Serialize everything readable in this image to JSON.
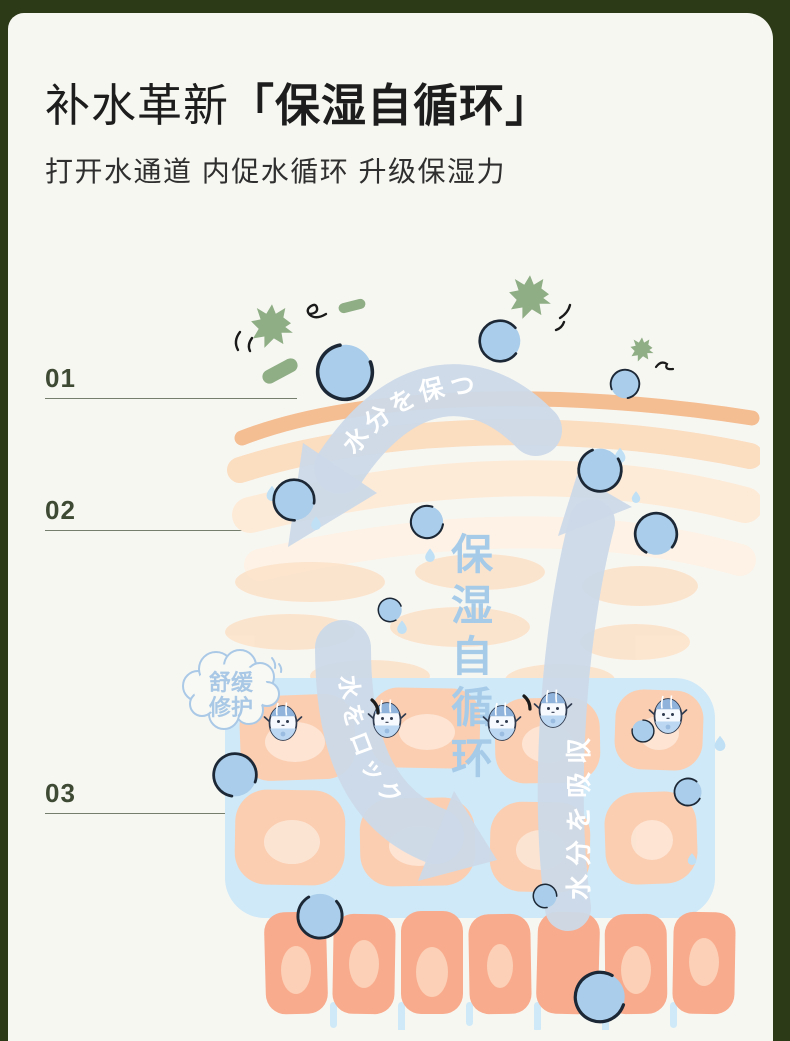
{
  "header": {
    "title_prefix": "补水革新",
    "title_quoted": "「保湿自循环」",
    "subtitle": "打开水通道 内促水循环 升级保湿力"
  },
  "steps": [
    {
      "label": "01"
    },
    {
      "label": "02"
    },
    {
      "label": "03"
    }
  ],
  "diagram": {
    "arrow_keep_moisture": "水分を保つ",
    "arrow_absorb_moisture": "水分を吸収",
    "arrow_lock_water": "水をロック",
    "cloud_line1": "舒缓",
    "cloud_line2": "修护",
    "center_chars": [
      "保",
      "湿",
      "自",
      "循",
      "环"
    ]
  },
  "colors": {
    "frame_green": "#2c3a17",
    "background": "#f7f7f2",
    "step_text": "#3e4a33",
    "skin_surface": "#f5bd92",
    "skin_cell": "#f9ab8d",
    "dermis_cell": "#fbceb1",
    "water_fill": "#a9cdea",
    "water_channel": "#cfe9f8",
    "arrow_blue": "#ccd9e8",
    "diagram_text_blue": "#a6cbe9",
    "pathogen_green": "#8fae85"
  }
}
